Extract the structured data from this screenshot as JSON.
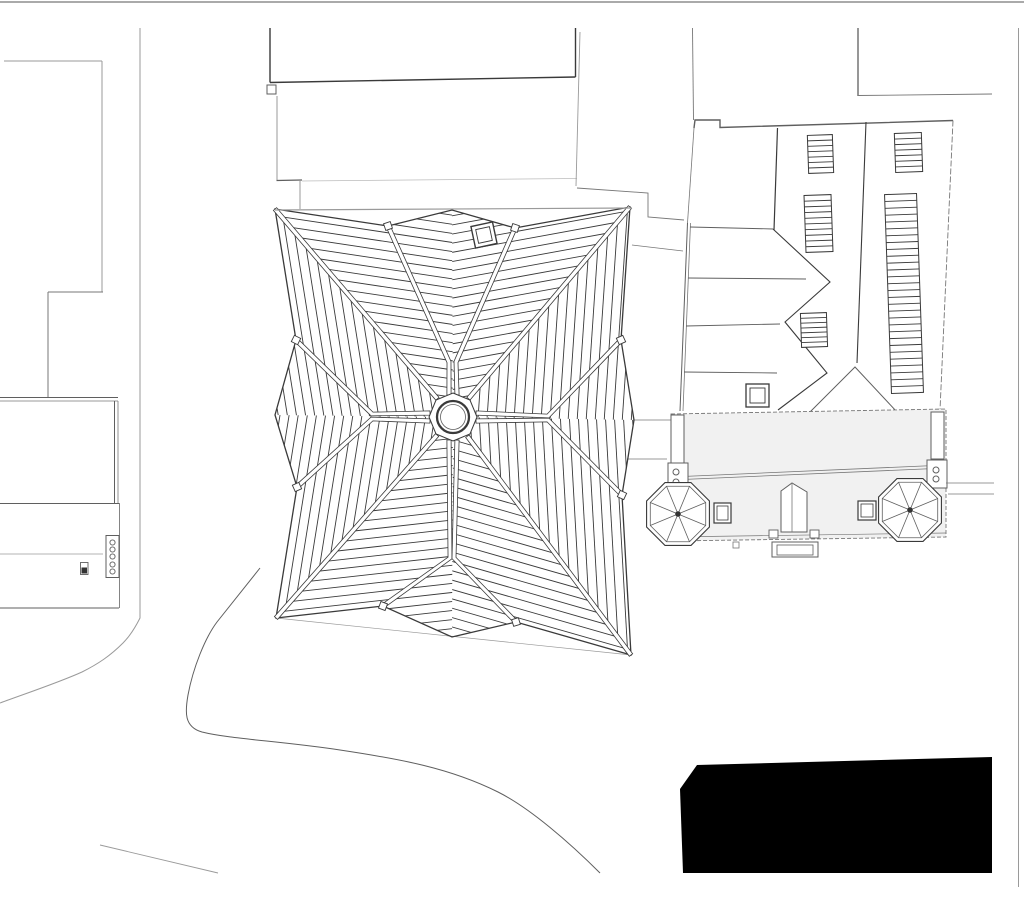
{
  "canvas": {
    "width": 1024,
    "height": 913,
    "background": "#ffffff"
  },
  "palette": {
    "line_dark": "#3a3a3a",
    "line_mid": "#5f5f5f",
    "line_soft": "#777777",
    "line_light": "#9a9a9a",
    "line_faint": "#bbbbbb",
    "fill_white": "#ffffff",
    "fill_band": "#f1f1f1",
    "fill_black": "#000000",
    "hub_dot": "#333333"
  },
  "drawing": {
    "kind": "architectural-site-roof-plan",
    "central_roof": {
      "hatch_spacing_px": 9,
      "sectors": 8,
      "oculus": {
        "outer_r": 16,
        "inner_r": 12.5
      },
      "hub_octagon_r": 24,
      "skylight": {
        "cx": 484,
        "cy": 235,
        "outer": 22,
        "inner": 14,
        "tilt_deg": -12
      }
    },
    "church": {
      "roof_hatch_panels": 5,
      "towers": [
        {
          "cx": 678,
          "cy": 514,
          "outer_r": 34,
          "inner_r": 30,
          "spokes": 8
        },
        {
          "cx": 910,
          "cy": 510,
          "outer_r": 34,
          "inner_r": 30,
          "spokes": 8
        }
      ],
      "pillar_circle_symbols": 2,
      "narthex_skylights": 2
    },
    "left_annex": {
      "meter_circles": 5
    },
    "black_mass_vertices": [
      [
        697,
        765
      ],
      [
        992,
        757
      ],
      [
        992,
        873
      ],
      [
        683,
        873
      ],
      [
        680,
        789
      ]
    ]
  }
}
